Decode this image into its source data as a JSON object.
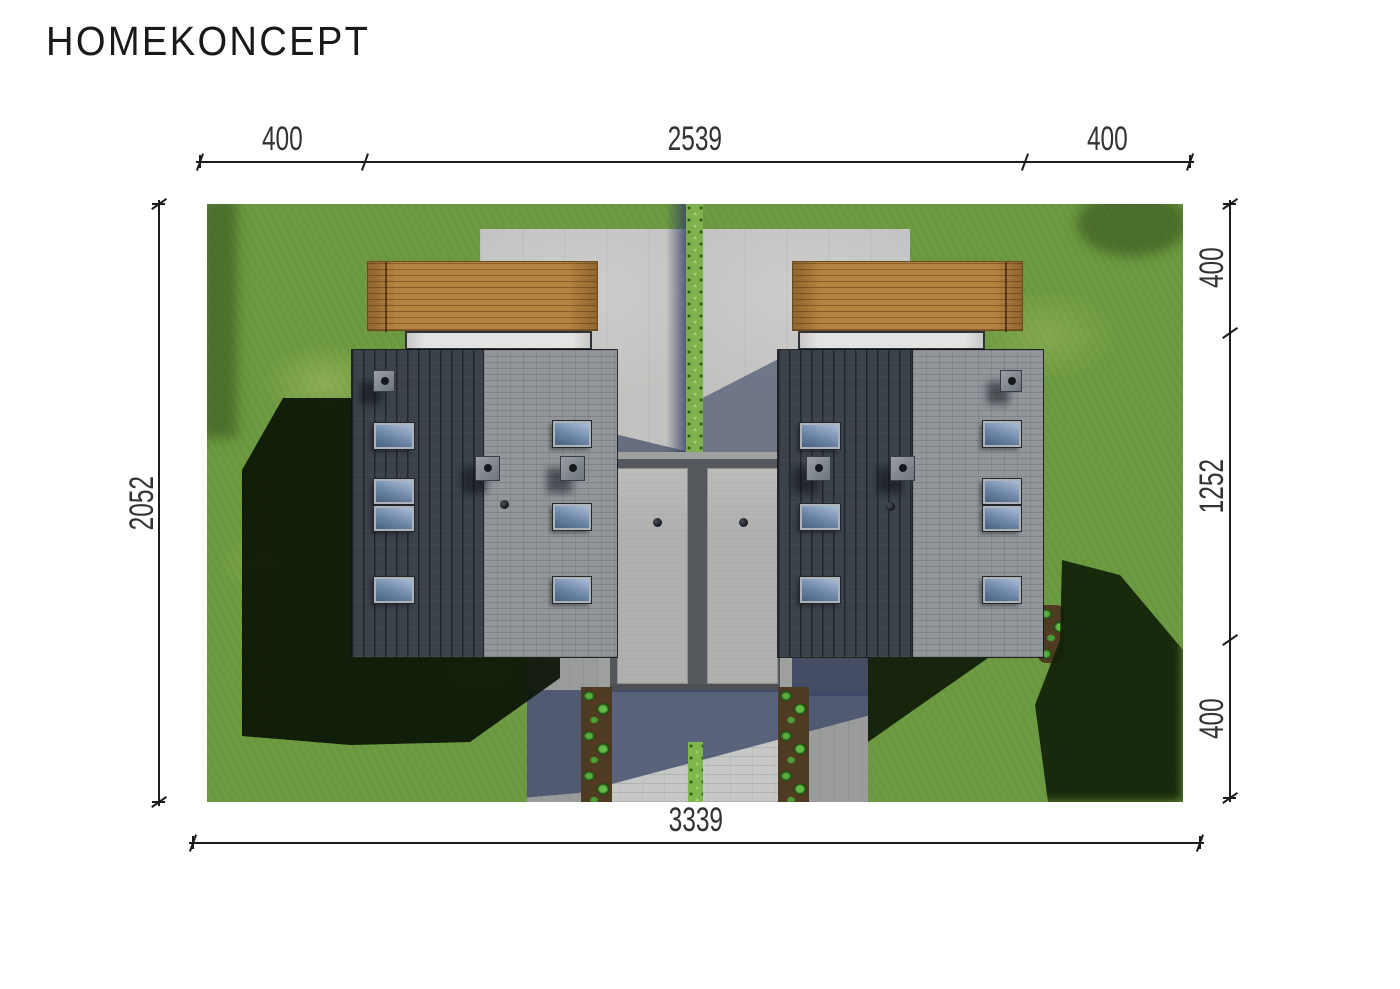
{
  "brand": {
    "logo_text": "HOMEKONCEPT"
  },
  "dimensions": {
    "top": {
      "segments": [
        "400",
        "2539",
        "400"
      ]
    },
    "right": {
      "segments": [
        "400",
        "1252",
        "400"
      ]
    },
    "left": {
      "total": "2052"
    },
    "bottom": {
      "total": "3339"
    }
  },
  "palette": {
    "background": "#ffffff",
    "dimension_line": "#1c1c1c",
    "grass": "#6d9b41",
    "roof_dark_seam": "#3c424a",
    "roof_light_tile": "#93979c",
    "deck_wood": "#b5823f",
    "concrete_driveway": "#c2c3c0",
    "paver_walkway": "#c6c8c5",
    "hedge_green": "#7fb14e",
    "shrub_green": "#56ad3c",
    "shadow_blue": "#4e5c7c",
    "shadow_tree": "#142309",
    "skylight_glass": "#6d86a8"
  },
  "scene": {
    "type": "aerial-site-plan-render",
    "buildings": "twin-houses-with-garages",
    "features": [
      "wooden-decks",
      "concrete-driveways",
      "central-hedge",
      "paver-walkway",
      "plant-borders",
      "skylights",
      "chimney-vents",
      "tree-shadows"
    ]
  }
}
